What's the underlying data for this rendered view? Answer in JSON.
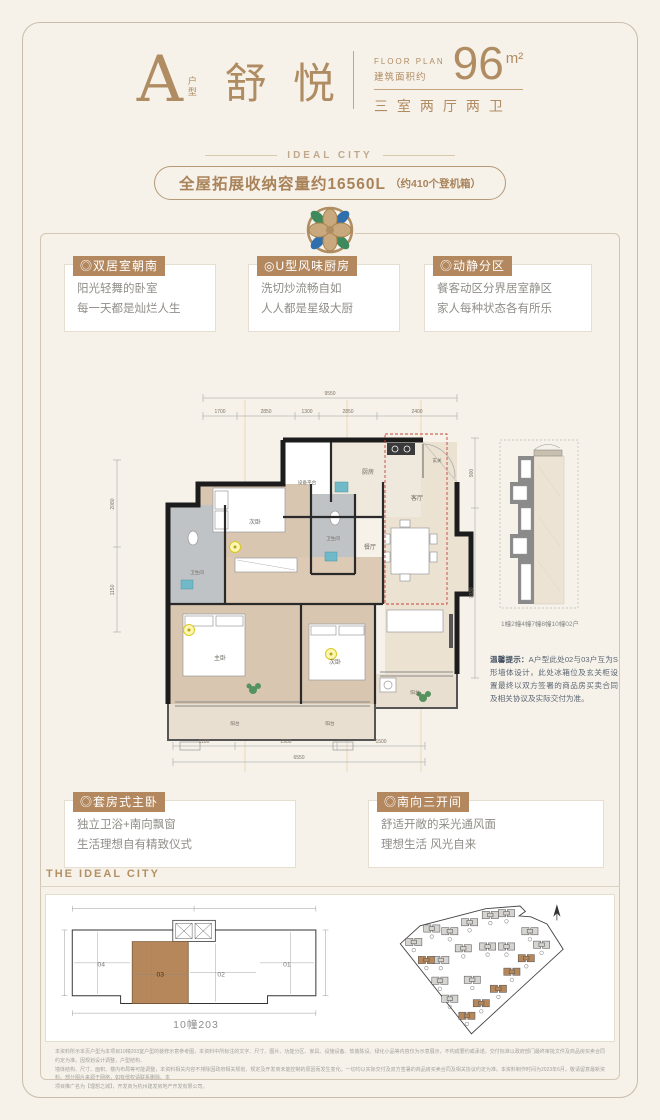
{
  "header": {
    "type_letter": "A",
    "type_label": "户型",
    "type_name": "舒悦",
    "floor_plan_en": "FLOOR PLAN",
    "area_label": "建筑面积约",
    "area_value": "96",
    "area_unit": "m²",
    "rooms_layout": "三室两厅两卫"
  },
  "logo": "IDEAL CITY",
  "banner": {
    "storage": "全屋拓展收纳容量约16560L",
    "note": "（约410个登机箱）"
  },
  "features": [
    {
      "title": "◎双居室朝南",
      "line1": "阳光轻舞的卧室",
      "line2": "每一天都是灿烂人生"
    },
    {
      "title": "◎U型风味厨房",
      "line1": "洗切炒流畅自如",
      "line2": "人人都是星级大厨"
    },
    {
      "title": "◎动静分区",
      "line1": "餐客动区分界居室静区",
      "line2": "家人每种状态各有所乐"
    },
    {
      "title": "◎套房式主卧",
      "line1": "独立卫浴+南向飘窗",
      "line2": "生活理想自有精致仪式"
    },
    {
      "title": "◎南向三开间",
      "line1": "舒适开敞的采光通风面",
      "line2": "理想生活 风光自来"
    }
  ],
  "plan": {
    "rooms": {
      "equip": "设备平台",
      "kitchen": "厨房",
      "entry": "玄关",
      "living": "客厅",
      "dining": "餐厅",
      "bed_upper": "次卧",
      "bath_a": "卫生间",
      "bath_b": "卫生间",
      "master": "主卧",
      "bed_lower": "次卧",
      "balcony_a": "阳台",
      "balcony_b": "阳台",
      "balcony_c": "阳台"
    },
    "dims": {
      "top_total": "9550",
      "top_segments": [
        "1700",
        "2850",
        "1300",
        "2850",
        "2400"
      ],
      "bottom_segments": [
        "1180",
        "2900",
        "1500"
      ],
      "bottom_total": "6550",
      "left_segments": [
        "2080",
        "1150"
      ],
      "right_segments": [
        "900",
        "7930"
      ]
    },
    "detail_caption": "1幢2幢4幢7幢8幢10幢02户",
    "tip_label": "温馨提示：",
    "tip_text": "A户型此处02与03户互为S形墙体设计，此处冰箱位及玄关柜设置最终以双方签署的商品房买卖合同及相关协议及实际交付为准。"
  },
  "footer": {
    "brand": "THE IDEAL CITY",
    "keyplan": {
      "units": [
        "04",
        "03",
        "02",
        "01"
      ],
      "caption": "10幢203"
    },
    "disclaimer_line1": "本资料所示本页户型为本项目10幢203室户型的装修示意参考图，本资料中所标注的文字、尺寸、图片、功能分区、家具、设施设备、软装陈设、绿化小品等内容仅为示意展示，不构成要约或承诺，交付标准以政府部门最终审批文件及商品房买卖合同约定为准。因规划设计调整，户型结构、",
    "disclaimer_line2": "墙体结构、尺寸、面积、楼内布局等可能调整，本资料相关内容不排除因政府相关规划、规定及开发商未能控制的原因而发生变化。一切均以实际交付及双方签署的商品房买卖合同及相关协议约定为准。本资料制作时间为2023年6月，敬请留意最新资料。部分图片来源于网络，如有侵权请联系删除。本",
    "disclaimer_line3": "项目推广名为【理想之城】，开发商为杭州建发房地产开发有限公司。"
  }
}
